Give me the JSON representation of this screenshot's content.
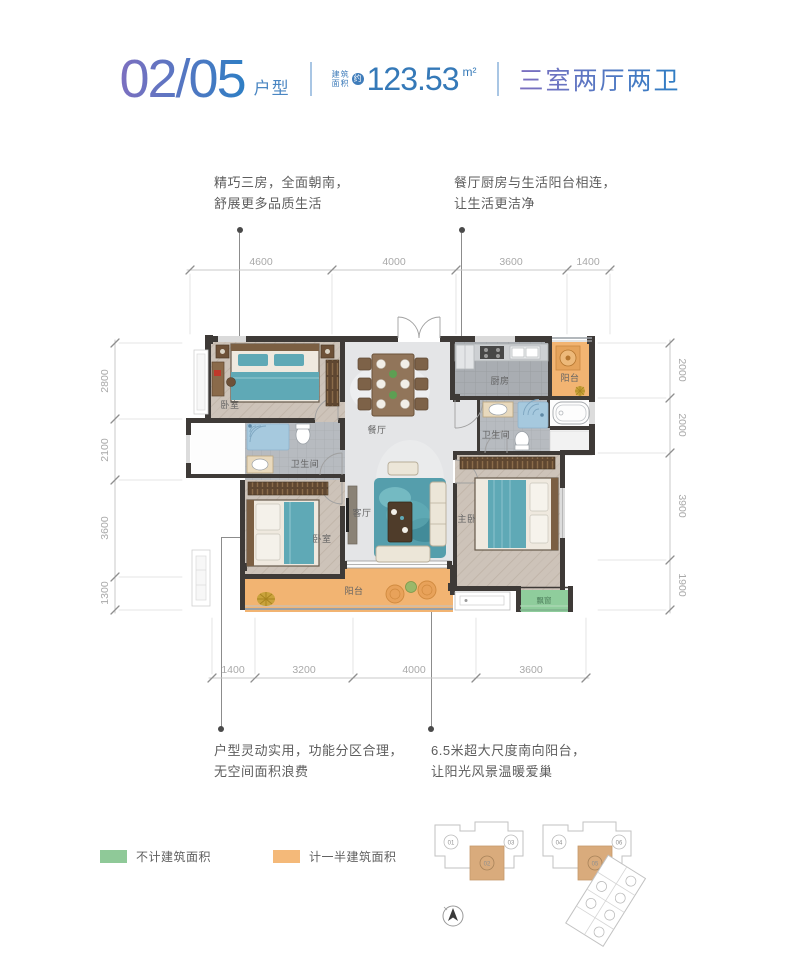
{
  "header": {
    "unit_number": "02/05",
    "unit_suffix": "户型",
    "area_label_line1": "建筑",
    "area_label_line2": "面积",
    "area_approx": "约",
    "area_value": "123.53",
    "area_unit": "m²",
    "layout_summary": "三室两厅两卫"
  },
  "annotations": {
    "top_left_line1": "精巧三房，全面朝南，",
    "top_left_line2": "舒展更多品质生活",
    "top_right_line1": "餐厅厨房与生活阳台相连，",
    "top_right_line2": "让生活更洁净",
    "bottom_left_line1": "户型灵动实用，功能分区合理，",
    "bottom_left_line2": "无空间面积浪费",
    "bottom_right_line1": "6.5米超大尺度南向阳台，",
    "bottom_right_line2": "让阳光风景温暖爱巢"
  },
  "dimensions": {
    "top": [
      "4600",
      "4000",
      "3600",
      "1400"
    ],
    "left": [
      "2800",
      "2100",
      "3600",
      "1300"
    ],
    "right": [
      "2000",
      "2000",
      "3900",
      "1900"
    ],
    "bottom": [
      "1400",
      "3200",
      "4000",
      "3600"
    ]
  },
  "rooms": {
    "bedroom_top_left": "卧室",
    "dining": "餐厅",
    "kitchen": "厨房",
    "service_balcony": "阳台",
    "bathroom_right": "卫生间",
    "bathroom_left": "卫生间",
    "living": "客厅",
    "bedroom_bottom_left": "卧室",
    "master_bedroom": "主卧",
    "main_balcony": "阳台",
    "bay_window": "飘窗"
  },
  "legend": {
    "items": [
      {
        "label": "不计建筑面积",
        "color": "#8fc998"
      },
      {
        "label": "计一半建筑面积",
        "color": "#f4b979"
      }
    ]
  },
  "site_plan": {
    "building_a_units": [
      "01",
      "02",
      "03"
    ],
    "building_b_units": [
      "04",
      "05",
      "06"
    ],
    "highlighted_units": [
      "02",
      "05"
    ]
  },
  "colors": {
    "title_blue": "#2e7ec4",
    "title_purple": "#7d6fc0",
    "wall": "#3e3a37",
    "wood_floor": "#cdc3b9",
    "tile_floor": "#a9adb2",
    "marble_floor": "#e4e5e7",
    "balcony_orange": "#f2b472",
    "bay_green": "#8fcd9c",
    "bed_teal": "#5fa9b6",
    "dim_text": "#a9a9a9",
    "annotation_text": "#5d5d5d"
  }
}
